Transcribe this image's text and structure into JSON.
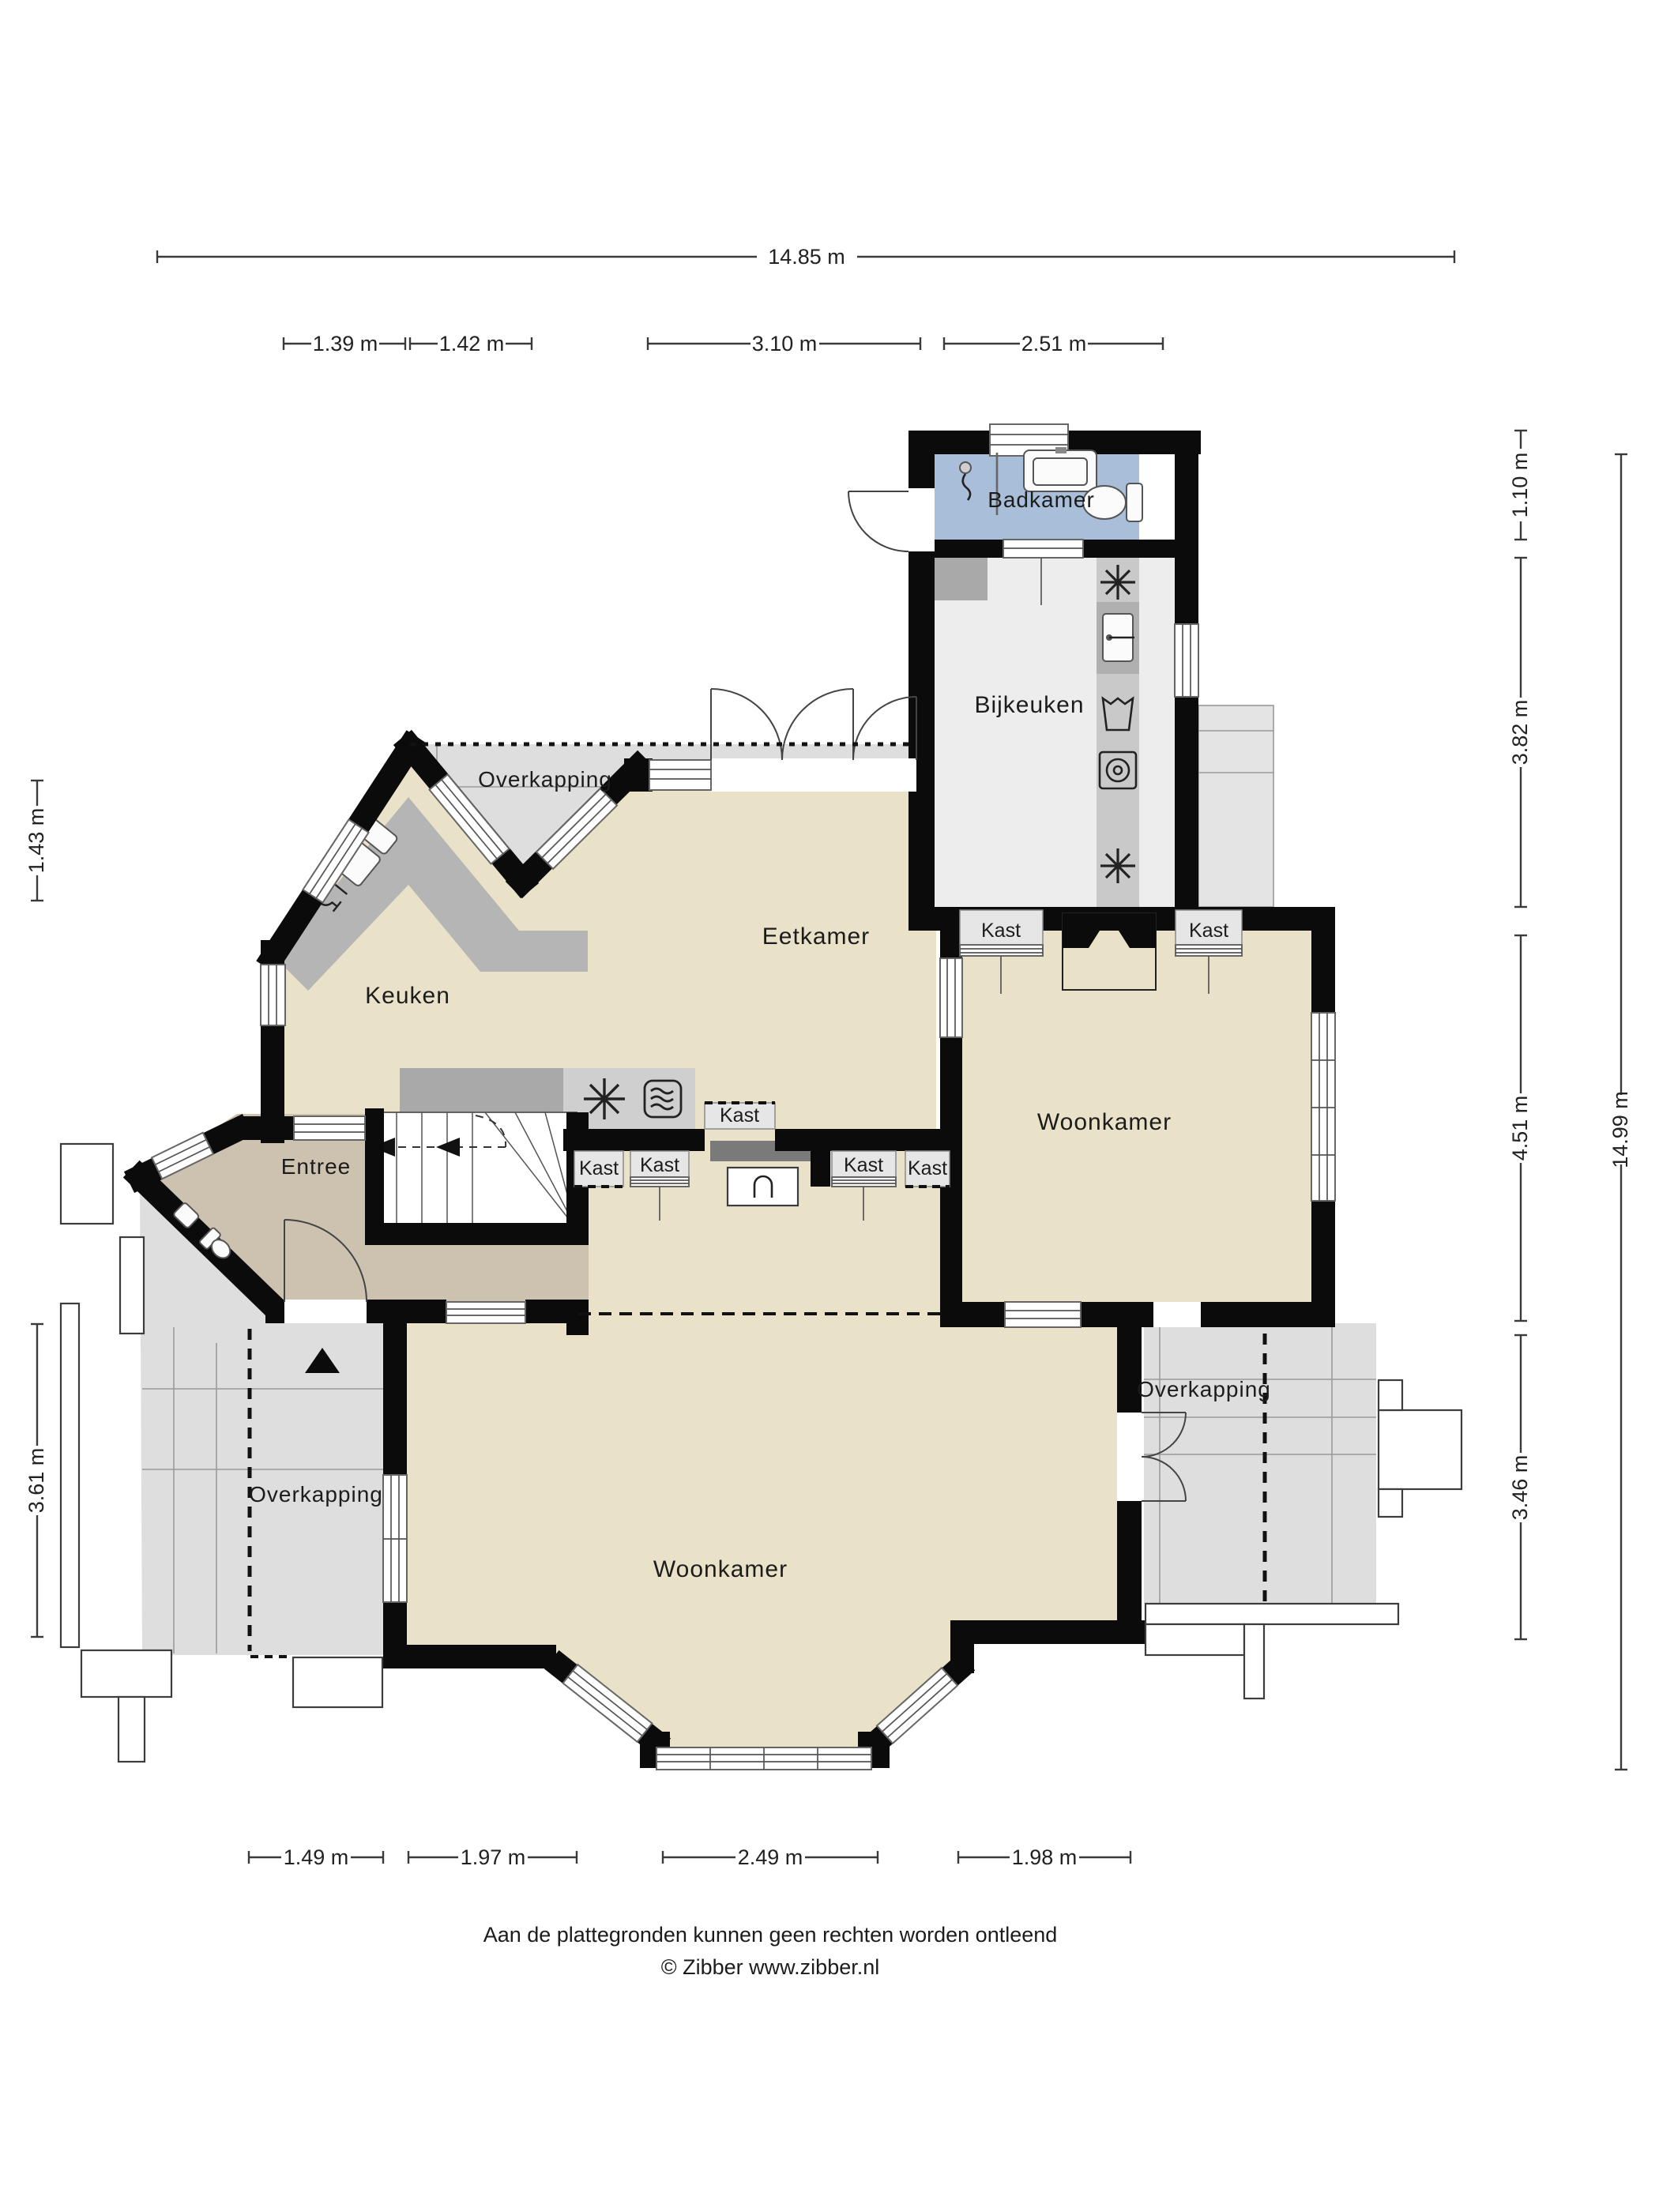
{
  "rooms": {
    "badkamer": "Badkamer",
    "bijkeuken": "Bijkeuken",
    "eetkamer": "Eetkamer",
    "keuken": "Keuken",
    "entree": "Entree",
    "woonkamer_boven": "Woonkamer",
    "woonkamer_beneden": "Woonkamer",
    "overkapping_top": "Overkapping",
    "overkapping_links": "Overkapping",
    "overkapping_rechts": "Overkapping"
  },
  "kasten": [
    {
      "label": "Kast"
    },
    {
      "label": "Kast"
    },
    {
      "label": "Kast"
    },
    {
      "label": "Kast"
    },
    {
      "label": "Kast"
    },
    {
      "label": "Kast"
    },
    {
      "label": "Kast"
    }
  ],
  "dimensions": {
    "top_total": "14.85 m",
    "top": [
      "1.39 m",
      "1.42 m",
      "3.10 m",
      "2.51 m"
    ],
    "right": [
      "1.10 m",
      "3.82 m",
      "4.51 m",
      "3.46 m"
    ],
    "right_total": "14.99 m",
    "left": [
      "1.43 m",
      "3.61 m"
    ],
    "bottom": [
      "1.49 m",
      "1.97 m",
      "2.49 m",
      "1.98 m"
    ]
  },
  "footer": {
    "line1": "Aan de plattegronden kunnen geen rechten worden ontleend",
    "line2": "© Zibber www.zibber.nl"
  },
  "colors": {
    "wall": "#0b0b0b",
    "cream": "#e9e1c8",
    "tan": "#cdc1af",
    "blue": "#a9bed8",
    "lightgray": "#dedede",
    "floor": "#ededed",
    "appl": "#c9c9c9",
    "counter": "#b5b5b5",
    "counter2": "#cfcfcf",
    "dark": "#7a7a7a",
    "kast": "#e6e6e6",
    "shed": "#e4e4e4"
  }
}
